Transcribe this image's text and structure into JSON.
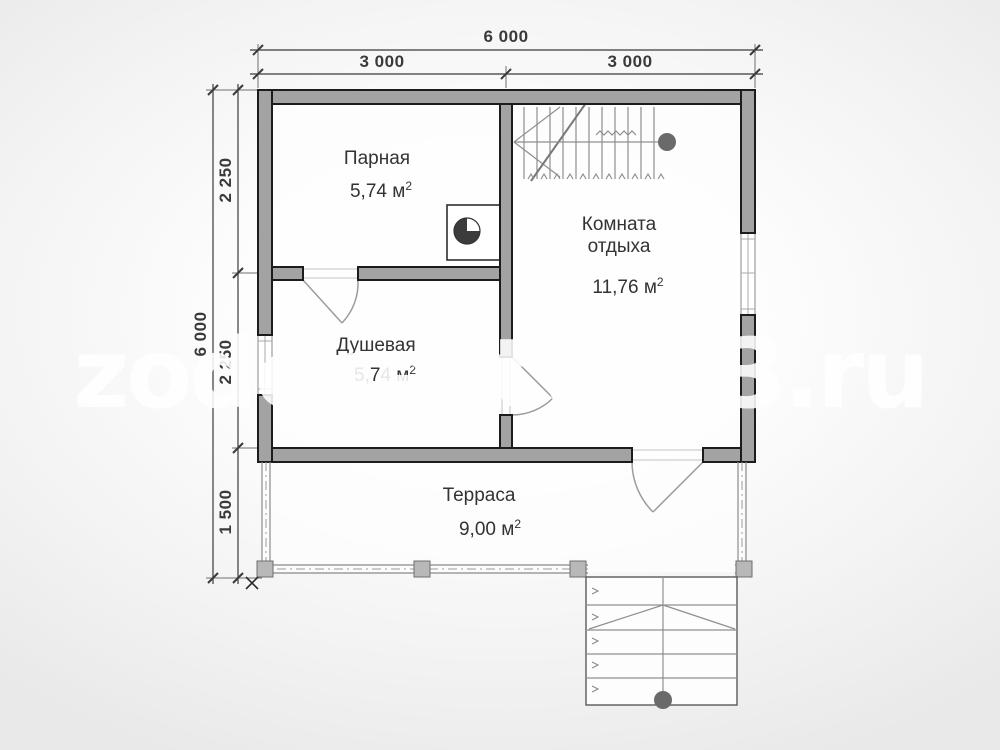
{
  "watermark": {
    "text": "zodchestvo53.ru"
  },
  "dimensions": {
    "top": {
      "total": "6 000",
      "left_half": "3 000",
      "right_half": "3 000"
    },
    "left": {
      "total": "6 000",
      "upper": "2 250",
      "middle": "2 250",
      "lower": "1 500"
    }
  },
  "rooms": {
    "steam_room": {
      "name": "Парная",
      "area": "5,74 м",
      "area_sup": "2"
    },
    "shower_room": {
      "name": "Душевая",
      "area": "5,74 м",
      "area_sup": "2"
    },
    "rest_room": {
      "name": "Комната отдыха",
      "area": "11,76 м",
      "area_sup": "2"
    },
    "terrace": {
      "name": "Терраса",
      "area": "9,00 м",
      "area_sup": "2"
    }
  },
  "symbols": {
    "stove": "sauna-stove (square with half-dark circle)",
    "upper_stairs": "staircase with break line and newel circle",
    "entrance_stairs": "entry steps with direction line and newel circle",
    "corner_marker": "x-mark"
  },
  "colors": {
    "wall_fill": "#a3a3a3",
    "wall_stroke": "#1c1c1c",
    "dimension": "#3a3a3a",
    "door_line": "#9c9c9c",
    "stair_line": "#8f8f8f",
    "newel": "#6a6a6a",
    "post_fill": "#b8b8b8",
    "post_stroke": "#6e6e6e",
    "watermark": "#ffffff"
  }
}
